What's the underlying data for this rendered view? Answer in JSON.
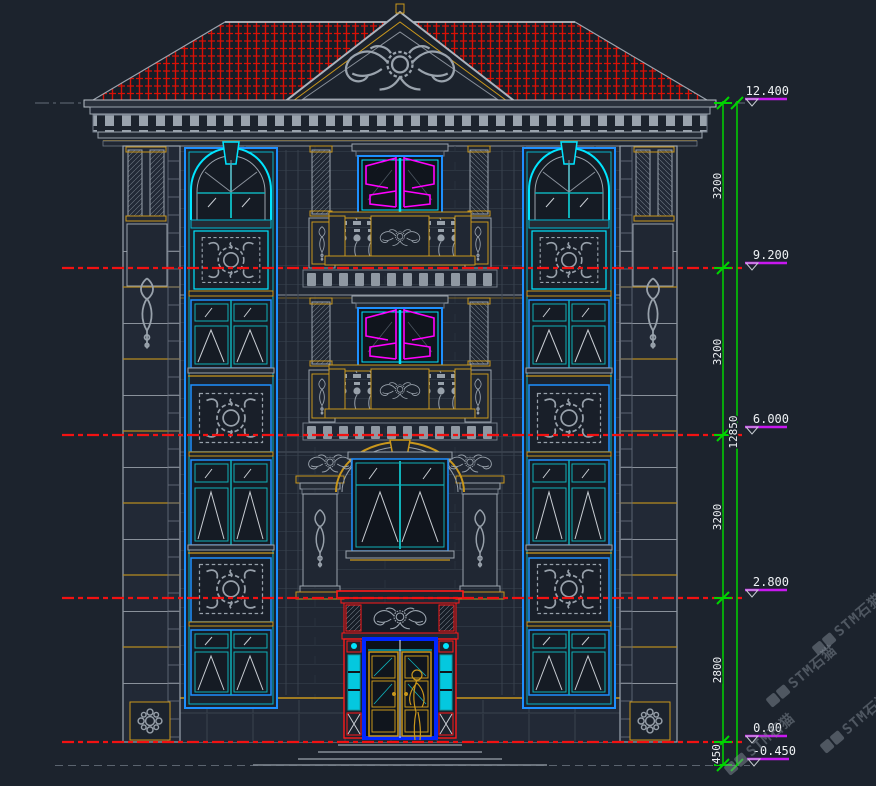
{
  "annotations": {
    "levels": [
      {
        "elevation": "12.400",
        "segment_dim": "3200"
      },
      {
        "elevation": "9.200",
        "segment_dim": "3200"
      },
      {
        "elevation": "6.000",
        "segment_dim": "3200"
      },
      {
        "elevation": "2.800",
        "segment_dim": "2800"
      },
      {
        "elevation": "0.00",
        "segment_dim": "450"
      },
      {
        "elevation": "-0.450"
      }
    ],
    "overall_dim": "12850"
  },
  "watermark": {
    "text": "STM石猫"
  },
  "colors": {
    "background": "#1c232d",
    "level_line_red": "#f21212",
    "roof_tile_red": "#d81005",
    "dimension_green": "#00d400",
    "elevation_marker_magenta": "#c818f0",
    "casement_magenta": "#ff00ff",
    "window_cyan": "#00e5ff",
    "frame_blue": "#1e90ff",
    "door_frame_blue": "#0026ff",
    "entrance_red": "#ff1a1a",
    "trim_gold": "#c9971c",
    "ornament_gray": "#9aa3ad",
    "text_white": "#eef1f4"
  }
}
